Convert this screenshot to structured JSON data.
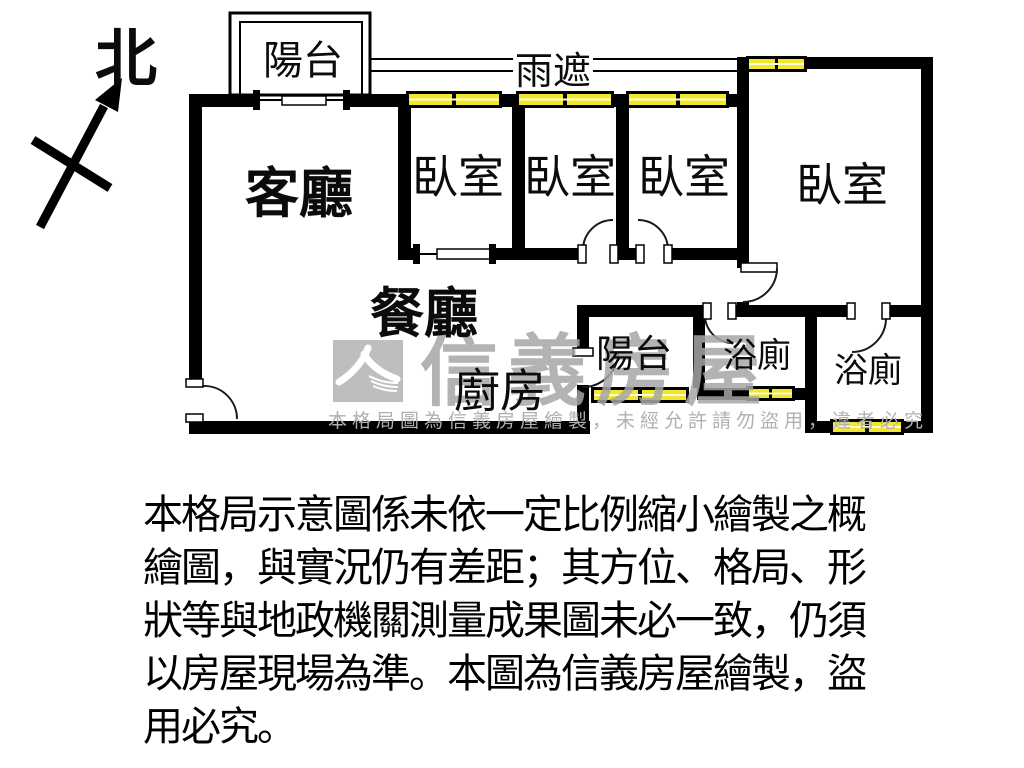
{
  "plan": {
    "compass": "北",
    "rooms": {
      "balcony_top": "陽台",
      "rain_cover": "雨遮",
      "living": "客廳",
      "bedroom_1": "臥室",
      "bedroom_2": "臥室",
      "bedroom_3": "臥室",
      "bedroom_master": "臥室",
      "dining": "餐廳",
      "kitchen": "廚房",
      "balcony_rear": "陽台",
      "bath_1": "浴廁",
      "bath_2": "浴廁"
    }
  },
  "watermark": {
    "brand": "信義房屋",
    "notice": "本格局圖為信義房屋繪製，未經允許請勿盜用，違者必究"
  },
  "disclaimer": {
    "lines": [
      "本格局示意圖係未依一定比例縮小繪製之概",
      "繪圖，與實況仍有差距；其方位、格局、形",
      "狀等與地政機關測量成果圖未必一致，仍須",
      "以房屋現場為準。本圖為信義房屋繪製，盜",
      "用必究。"
    ]
  },
  "colors": {
    "wall": "#000000",
    "window_fill": "#f2e72c",
    "watermark_gray": "#a6a6a6"
  }
}
